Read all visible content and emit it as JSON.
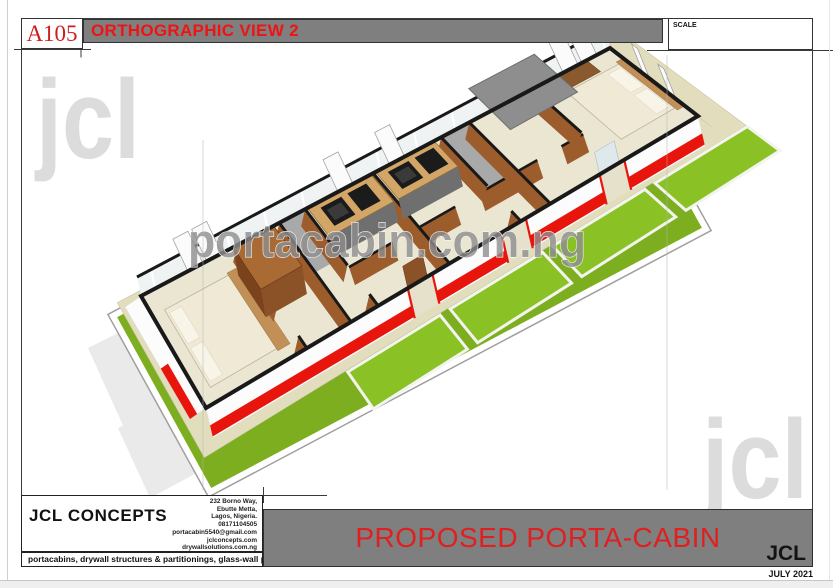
{
  "sheet": {
    "drawing_number": "A105",
    "view_title": "ORTHOGRAPHIC VIEW 2",
    "scale_label": "SCALE",
    "project_title": "PROPOSED PORTA-CABIN",
    "logo_small": "JCL",
    "date": "JULY 2021"
  },
  "company": {
    "name": "JCL CONCEPTS",
    "address_lines": [
      "232 Borno Way,",
      "Ebutte Metta,",
      "Lagos, Nigeria.",
      "08171104505",
      "portacabin5540@gmail.com",
      "jclconcepts.com",
      "drywallsolutions.com.ng"
    ],
    "tagline": "portacabins, drywall structures & partitionings, glass-wall partitiongs."
  },
  "watermarks": {
    "corner_top_left": "jcl",
    "corner_bottom_right": "jcl",
    "center": "portacabin.com.ng"
  },
  "drawing": {
    "colors": {
      "lawn": "#7cae20",
      "lawnPanel": "#8ac226",
      "panelFrame": "#f4f4ee",
      "pathStroke": "#9f9f9f",
      "walkway": "#e2debd",
      "floor": "#eae6d2",
      "floorGray": "#a9a9a9",
      "wallWhite": "#fcfcfc",
      "red": "#e8150d",
      "black": "#191919",
      "partition": "#9c5c2c",
      "woodDark": "#7a431b",
      "woodTop": "#a96a33",
      "doorBrown": "#8a5226",
      "counter": "#d3a567",
      "counterEdge": "#8a6a3a",
      "cabinet": "#6f6f6f",
      "appliance": "#1b1b1b",
      "applianceInner": "#3a3a3a",
      "bed": "#efe9d6",
      "pillow": "#f8f4e8",
      "headboard": "#c29057",
      "desk": "#8a5a2e",
      "glass": "#dfe9ec",
      "backBand": "#eef2f3",
      "roof": "#8e8e8e",
      "roofEdge": "#6f6f6f",
      "shadow": "#eaeaea",
      "sash": "#fbfbfb",
      "sashEdge": "#9a9a9a"
    },
    "quad": {
      "A": [
        206,
        408
      ],
      "B": [
        698,
        116
      ],
      "C": [
        610,
        48
      ],
      "D": [
        141,
        296
      ]
    },
    "plot": [
      [
        113,
        316
      ],
      [
        210,
        492
      ],
      [
        706,
        229
      ],
      [
        608,
        53
      ]
    ],
    "shadows": [
      [
        [
          88,
          348
        ],
        [
          148,
          318
        ],
        [
          214,
          462
        ],
        [
          154,
          494
        ]
      ],
      [
        [
          118,
          428
        ],
        [
          176,
          398
        ],
        [
          206,
          468
        ],
        [
          150,
          498
        ]
      ]
    ],
    "walkway": {
      "t0": -0.045,
      "t1": 1.04,
      "s0": -0.32,
      "s1": 1.04
    },
    "frontPanels": {
      "s0": -0.7,
      "s1": -0.335,
      "t": [
        [
          0.24,
          0.425
        ],
        [
          0.445,
          0.63
        ],
        [
          0.65,
          0.835
        ],
        [
          0.855,
          1.04
        ]
      ]
    },
    "grayRooms": [
      [
        0.295,
        0.35,
        0.5,
        1
      ],
      [
        0.64,
        0.7,
        0.35,
        1
      ]
    ],
    "beds": [
      {
        "t": [
          0.025,
          0.16
        ],
        "s": [
          0.12,
          0.82
        ],
        "pillows": [
          [
            0.03,
            0.055,
            0.16,
            0.46
          ],
          [
            0.03,
            0.055,
            0.5,
            0.78
          ]
        ],
        "head": [
          0.16,
          0.185,
          0.1,
          0.84
        ]
      },
      {
        "t": [
          0.875,
          0.985
        ],
        "s": [
          0.18,
          0.82
        ],
        "pillows": [
          [
            0.955,
            0.982,
            0.22,
            0.48
          ],
          [
            0.955,
            0.982,
            0.52,
            0.78
          ]
        ],
        "head": [
          0.985,
          1.0,
          0.15,
          0.85
        ]
      }
    ],
    "desk": [
      0.86,
      0.95,
      0.84,
      1.02
    ],
    "wardrobe": {
      "t": [
        0.175,
        0.26
      ],
      "s": [
        0.38,
        0.78
      ],
      "lift": [
        -5,
        -28
      ]
    },
    "kitchens": [
      {
        "t": [
          0.355,
          0.49
        ],
        "sink": [
          0.375,
          0.419
        ],
        "cook": [
          0.432,
          0.472
        ]
      },
      {
        "t": [
          0.5,
          0.625
        ],
        "sink": [
          0.518,
          0.562
        ],
        "cook": [
          0.575,
          0.615
        ]
      }
    ],
    "counterS": [
      0.7,
      1.0
    ],
    "partitions": [
      {
        "t": 0.205,
        "gap": [
          0.12,
          0.42
        ]
      },
      {
        "t": 0.295
      },
      {
        "t": 0.35,
        "gap": [
          0.12,
          0.42
        ]
      },
      {
        "t": 0.495
      },
      {
        "t": 0.64,
        "gap": [
          0.12,
          0.42
        ]
      },
      {
        "t": 0.7
      },
      {
        "t": 0.835,
        "gap": [
          0.12,
          0.42
        ]
      }
    ],
    "corridor": {
      "s": 0.4,
      "segs": [
        [
          0.35,
          0.44
        ],
        [
          0.49,
          0.57
        ],
        [
          0.62,
          0.74
        ],
        [
          0.79,
          0.835
        ]
      ]
    },
    "roof": {
      "t": [
        0.72,
        0.86
      ],
      "s": [
        0.55,
        1.06
      ],
      "lift": [
        -5,
        -24
      ]
    },
    "backWall": {
      "up": [
        -4,
        -19
      ],
      "mullionStep": 0.08,
      "sashes": [
        0.1,
        0.14,
        0.42,
        0.53,
        0.9,
        0.94
      ],
      "sashW": 0.032,
      "sashVec": [
        -15,
        -32
      ]
    },
    "frontWall": {
      "drop": [
        7,
        30
      ],
      "stripe": [
        0.58,
        0.95
      ],
      "gaps": [
        [
          0.41,
          0.46
        ],
        [
          0.6,
          0.65
        ],
        [
          0.8,
          0.85
        ]
      ],
      "door": 0,
      "glassDoor": 2,
      "leafVec": [
        -5,
        -22
      ]
    },
    "endNear": {
      "out": [
        -16,
        11
      ],
      "stripe": [
        0.55,
        1.0
      ],
      "stripeS": [
        0,
        0.45
      ]
    },
    "endFar": {
      "out": [
        15,
        12
      ],
      "stripe": [
        0.62,
        1.0
      ],
      "glassS": [
        [
          0.15,
          0.45
        ],
        [
          0.52,
          0.82
        ]
      ],
      "sashes": [
        0.25,
        0.55
      ]
    },
    "guides": [
      [
        203,
        140,
        203,
        490
      ],
      [
        667,
        55,
        667,
        490
      ]
    ],
    "ticks": [
      [
        14,
        49.5,
        91,
        49.5
      ],
      [
        81,
        44,
        81,
        57.5
      ],
      [
        647,
        50.5,
        833,
        50.5
      ],
      [
        21,
        495.5,
        327,
        495.5
      ],
      [
        263.5,
        487,
        263.5,
        503
      ]
    ]
  }
}
